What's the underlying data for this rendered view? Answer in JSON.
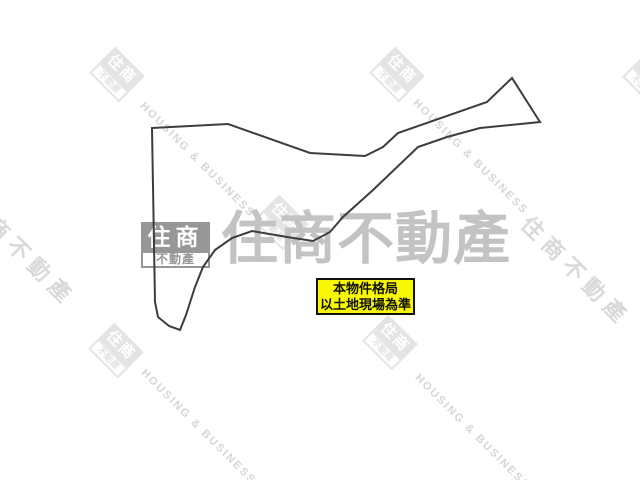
{
  "image": {
    "description": "Land lot outline drawing with real-estate agency watermarks",
    "background": "#ffffff"
  },
  "plan": {
    "stroke_color": "#3d3d3d",
    "stroke_width": 2,
    "points": "152,128 228,124 310,153 365,156 383,147 398,133 487,102 512,78 540,122 480,128 447,137 418,147 373,190 343,217 330,232 313,241 287,237 252,231 232,238 215,250 203,267 195,287 186,315 180,330 169,326 158,317 155,302"
  },
  "note_box": {
    "line1": "本物件格局",
    "line2": "以土地現場為準",
    "bg_color": "#f8f800",
    "border_color": "#111111",
    "text_color": "#111111"
  },
  "watermarks": {
    "brand_en": "HOUSING & BUSINESS",
    "brand_zh": "住商不動產",
    "logo_top": "住商",
    "logo_bottom": "不動產",
    "colors": {
      "solid_logo_gray": "#8f8f8f",
      "big_center_text": "#c3c3c3",
      "diagonal_text": "#d8d8d8",
      "light_logo": "#e4e4e4"
    }
  }
}
